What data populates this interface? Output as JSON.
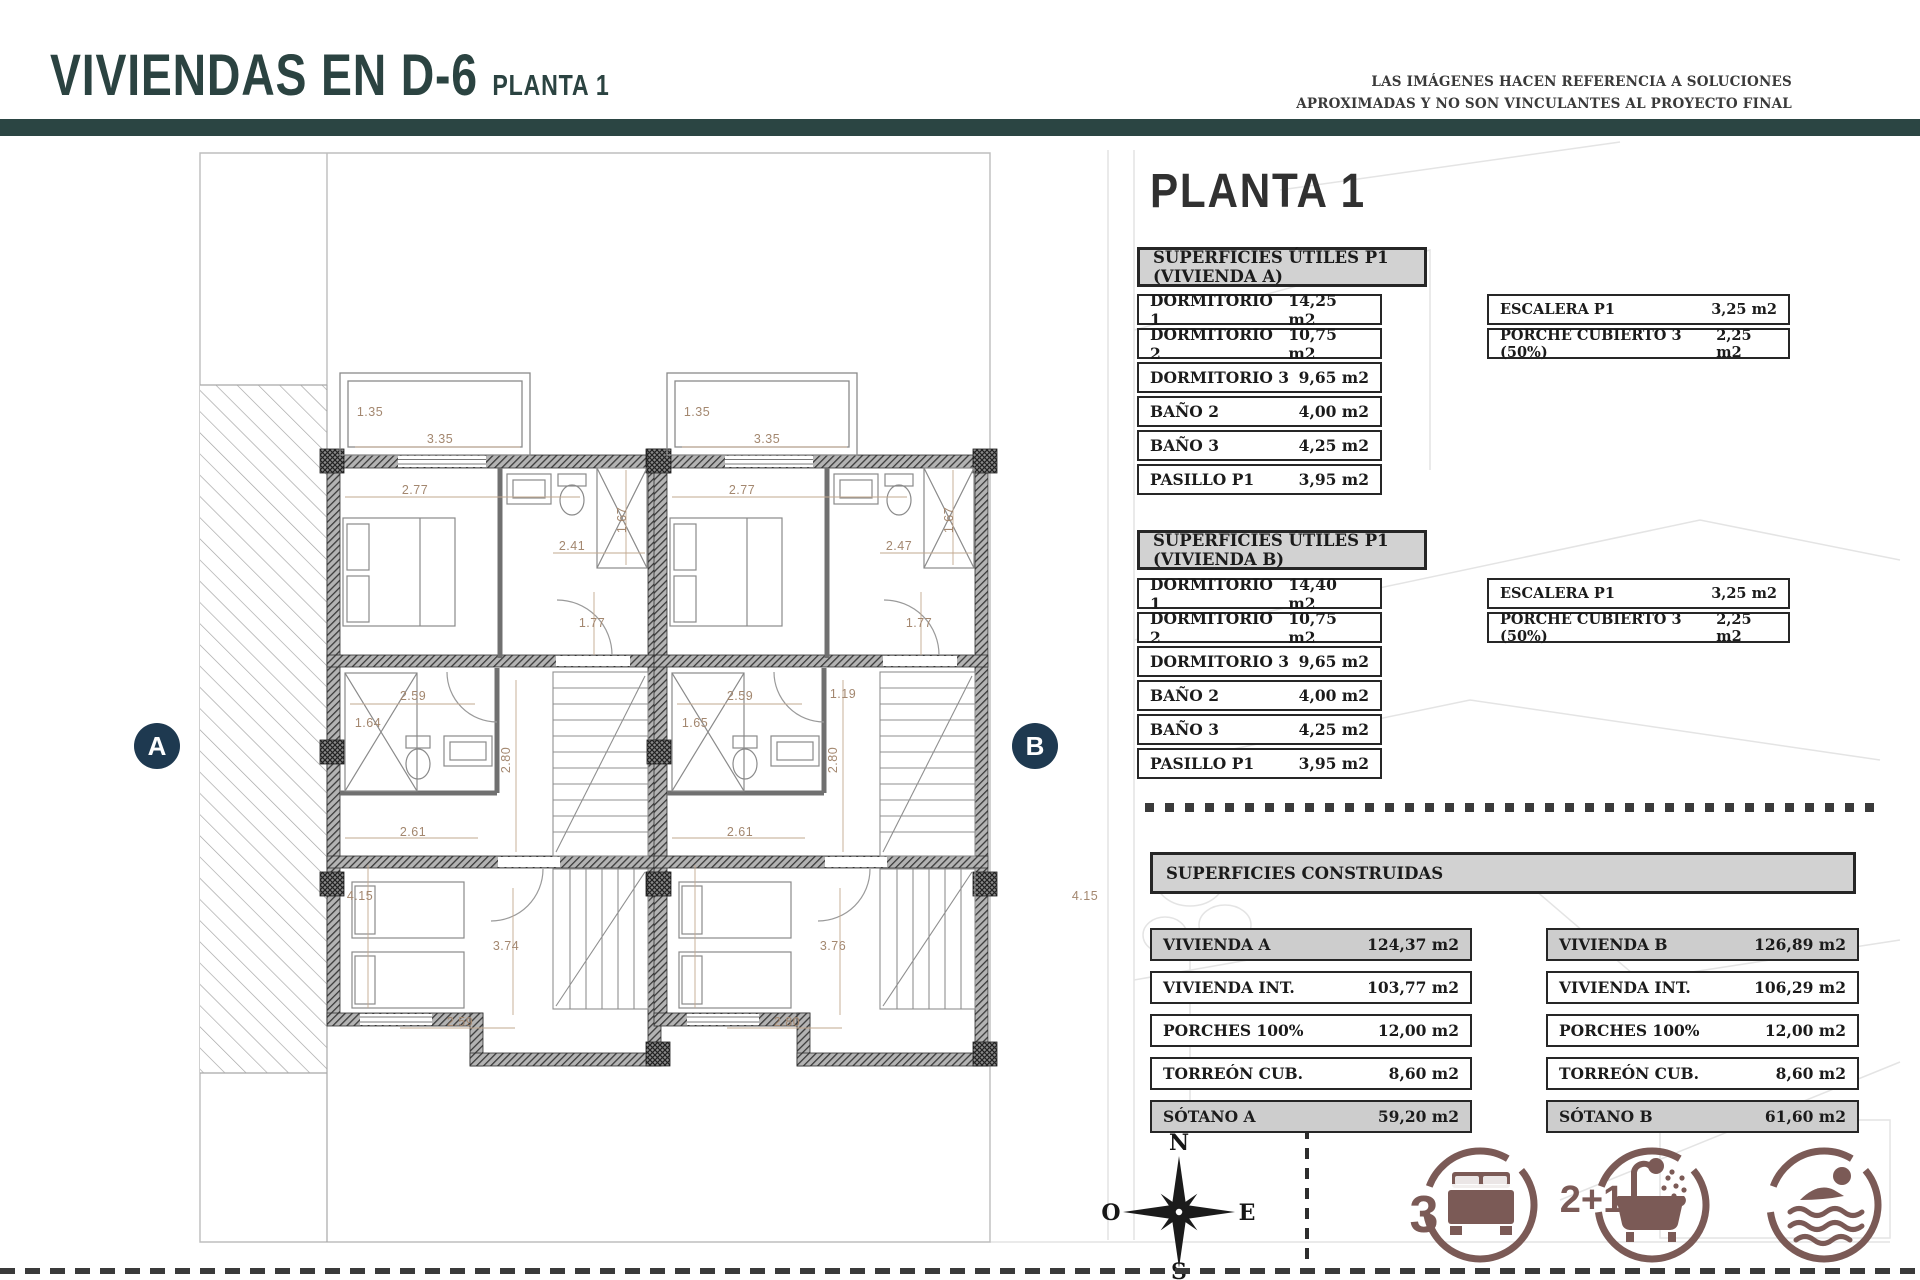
{
  "header": {
    "title": "VIVIENDAS EN D-6",
    "subtitle": "PLANTA 1",
    "disclaimer_line1": "LAS IMÁGENES HACEN REFERENCIA A SOLUCIONES",
    "disclaimer_line2": "APROXIMADAS Y NO SON VINCULANTES AL PROYECTO FINAL"
  },
  "panel": {
    "heading": "PLANTA 1",
    "table_a": {
      "title": "SUPERFICIES ÚTILES P1 (VIVIENDA A)",
      "rows": [
        {
          "label": "DORMITORIO 1",
          "value": "14,25 m2"
        },
        {
          "label": "DORMITORIO 2",
          "value": "10,75 m2"
        },
        {
          "label": "DORMITORIO 3",
          "value": "9,65 m2"
        },
        {
          "label": "BAÑO 2",
          "value": "4,00 m2"
        },
        {
          "label": "BAÑO 3",
          "value": "4,25 m2"
        },
        {
          "label": "PASILLO P1",
          "value": "3,95 m2"
        }
      ],
      "side": [
        {
          "label": "ESCALERA P1",
          "value": "3,25 m2"
        },
        {
          "label": "PORCHE CUBIERTO 3 (50%)",
          "value": "2,25 m2"
        }
      ]
    },
    "table_b": {
      "title": "SUPERFICIES ÚTILES P1 (VIVIENDA B)",
      "rows": [
        {
          "label": "DORMITORIO 1",
          "value": "14,40 m2"
        },
        {
          "label": "DORMITORIO 2",
          "value": "10,75 m2"
        },
        {
          "label": "DORMITORIO 3",
          "value": "9,65 m2"
        },
        {
          "label": "BAÑO 2",
          "value": "4,00 m2"
        },
        {
          "label": "BAÑO 3",
          "value": "4,25 m2"
        },
        {
          "label": "PASILLO P1",
          "value": "3,95 m2"
        }
      ],
      "side": [
        {
          "label": "ESCALERA P1",
          "value": "3,25 m2"
        },
        {
          "label": "PORCHE CUBIERTO 3 (50%)",
          "value": "2,25 m2"
        }
      ]
    },
    "built": {
      "title": "SUPERFICIES CONSTRUIDAS",
      "left": [
        {
          "label": "VIVIENDA A",
          "value": "124,37 m2"
        },
        {
          "label": "VIVIENDA INT.",
          "value": "103,77 m2"
        },
        {
          "label": "PORCHES 100%",
          "value": "12,00 m2"
        },
        {
          "label": "TORREÓN CUB.",
          "value": "8,60 m2"
        },
        {
          "label": "SÓTANO A",
          "value": "59,20 m2"
        }
      ],
      "right": [
        {
          "label": "VIVIENDA B",
          "value": "126,89 m2"
        },
        {
          "label": "VIVIENDA INT.",
          "value": "106,29 m2"
        },
        {
          "label": "PORCHES 100%",
          "value": "12,00 m2"
        },
        {
          "label": "TORREÓN CUB.",
          "value": "8,60 m2"
        },
        {
          "label": "SÓTANO B",
          "value": "61,60 m2"
        }
      ]
    }
  },
  "plan": {
    "marker_a": "A",
    "marker_b": "B",
    "compass": {
      "n": "N",
      "e": "E",
      "s": "S",
      "w": "O"
    },
    "dims": [
      {
        "t": "1.35"
      },
      {
        "t": "3.35"
      },
      {
        "t": "2.77"
      },
      {
        "t": "2.41"
      },
      {
        "t": "1.67"
      },
      {
        "t": "1.77"
      },
      {
        "t": "2.59"
      },
      {
        "t": "1.64"
      },
      {
        "t": "2.80"
      },
      {
        "t": "2.61"
      },
      {
        "t": "4.15"
      },
      {
        "t": "3.74"
      },
      {
        "t": "2.59"
      },
      {
        "t": "1.35"
      },
      {
        "t": "3.35"
      },
      {
        "t": "2.77"
      },
      {
        "t": "2.47"
      },
      {
        "t": "1.67"
      },
      {
        "t": "1.77"
      },
      {
        "t": "1.19"
      },
      {
        "t": "2.59"
      },
      {
        "t": "1.65"
      },
      {
        "t": "2.80"
      },
      {
        "t": "2.61"
      },
      {
        "t": "4.15"
      },
      {
        "t": "3.76"
      },
      {
        "t": "2.80"
      }
    ]
  },
  "features": {
    "bedrooms": "3",
    "bathrooms": "2+1"
  },
  "colors": {
    "teal": "#2b4543",
    "navy": "#1e3950",
    "maroon": "#7b5a56",
    "dim_text": "#a3876f"
  }
}
